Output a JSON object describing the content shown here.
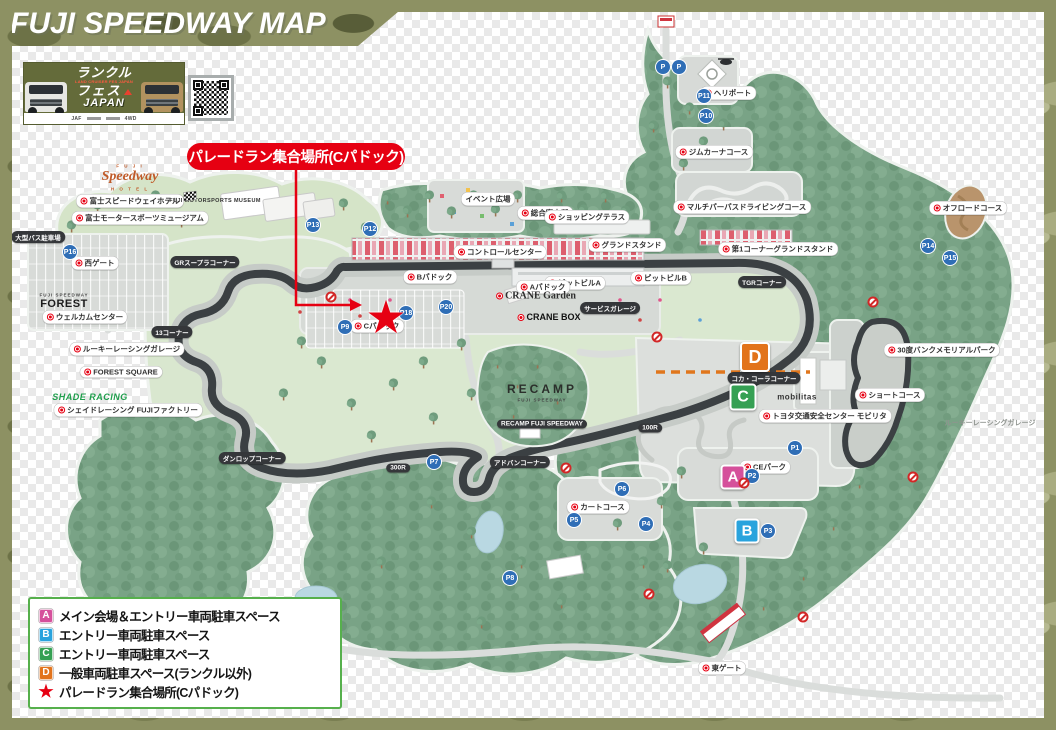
{
  "header": {
    "title": "FUJI SPEEDWAY MAP"
  },
  "banner": {
    "line1": "ランクル",
    "tagline": "LAND CRUISER FES JAPAN",
    "line2": "フェス",
    "line3": "JAPAN",
    "sponsor_left": "JAF",
    "sponsor_right": "4WD"
  },
  "callout": {
    "text": "パレードラン集合場所(Cパドック)"
  },
  "legend": {
    "items": [
      {
        "key": "A",
        "color": "#d5509b",
        "label": "メイン会場＆エントリー車両駐車スペース"
      },
      {
        "key": "B",
        "color": "#29a3dd",
        "label": "エントリー車両駐車スペース"
      },
      {
        "key": "C",
        "color": "#35a053",
        "label": "エントリー車両駐車スペース"
      },
      {
        "key": "D",
        "color": "#e2731b",
        "label": "一般車両駐車スペース(ランクル以外)"
      },
      {
        "key": "★",
        "color": "#e60012",
        "label": "パレードラン集合場所(Cパドック)"
      }
    ]
  },
  "colors": {
    "accent_red": "#e60012",
    "camo_olive": "#8d9163",
    "forest_green": "#79a386",
    "track_dark": "#3b4043",
    "parking_blue": "#2f6eb6",
    "dashed_orange": "#e0761c",
    "legend_border": "#56b04c"
  },
  "map": {
    "star": {
      "x": 374,
      "y": 305,
      "glyph": "★"
    },
    "area_markers": [
      {
        "letter": "A",
        "x": 733,
        "y": 477,
        "size": 21,
        "color": "#d5509b"
      },
      {
        "letter": "B",
        "x": 747,
        "y": 531,
        "size": 21,
        "color": "#29a3dd"
      },
      {
        "letter": "C",
        "x": 743,
        "y": 397,
        "size": 23,
        "color": "#35a053"
      },
      {
        "letter": "D",
        "x": 755,
        "y": 357,
        "size": 26,
        "color": "#e2731b"
      }
    ],
    "parkings": [
      {
        "n": "P",
        "x": 663,
        "y": 67
      },
      {
        "n": "P",
        "x": 679,
        "y": 67
      },
      {
        "n": "P11",
        "x": 704,
        "y": 96
      },
      {
        "n": "P10",
        "x": 706,
        "y": 116
      },
      {
        "n": "P13",
        "x": 313,
        "y": 225
      },
      {
        "n": "P12",
        "x": 370,
        "y": 229
      },
      {
        "n": "P14",
        "x": 928,
        "y": 246
      },
      {
        "n": "P15",
        "x": 950,
        "y": 258
      },
      {
        "n": "P16",
        "x": 70,
        "y": 252
      },
      {
        "n": "P9",
        "x": 345,
        "y": 327
      },
      {
        "n": "P18",
        "x": 406,
        "y": 313
      },
      {
        "n": "P20",
        "x": 446,
        "y": 307
      },
      {
        "n": "P7",
        "x": 434,
        "y": 462
      },
      {
        "n": "P8",
        "x": 510,
        "y": 578
      },
      {
        "n": "P6",
        "x": 622,
        "y": 489
      },
      {
        "n": "P5",
        "x": 574,
        "y": 520
      },
      {
        "n": "P4",
        "x": 646,
        "y": 524
      },
      {
        "n": "P3",
        "x": 768,
        "y": 531
      },
      {
        "n": "P2",
        "x": 752,
        "y": 476
      },
      {
        "n": "P1",
        "x": 795,
        "y": 448
      }
    ],
    "no_entry": [
      [
        331,
        297
      ],
      [
        657,
        337
      ],
      [
        744,
        483
      ],
      [
        873,
        302
      ],
      [
        913,
        477
      ],
      [
        649,
        594
      ],
      [
        803,
        617
      ],
      [
        566,
        468
      ]
    ],
    "labels": [
      {
        "name": "label-fuji-sub",
        "text": "F U J I",
        "x": 130,
        "y": 166,
        "t": "script-sub"
      },
      {
        "name": "label-speedway-hotel-script",
        "text": "Speedway",
        "x": 130,
        "y": 177,
        "t": "script"
      },
      {
        "name": "label-hotel-sub",
        "text": "H O T E L",
        "x": 130,
        "y": 189,
        "t": "script-sub"
      },
      {
        "name": "label-fuji-speedway-hotel",
        "text": "富士スピードウェイホテル",
        "x": 130,
        "y": 201,
        "t": "pill",
        "dot": true
      },
      {
        "name": "label-fuji-motorsports-museum-en",
        "text": "FUJI MOTORSPORTS MUSEUM",
        "x": 215,
        "y": 201,
        "t": "plain"
      },
      {
        "name": "label-fuji-motorsports-museum",
        "text": "富士モータースポーツミュージアム",
        "x": 140,
        "y": 218,
        "t": "pill",
        "dot": true
      },
      {
        "name": "label-bus-parking",
        "text": "大型バス駐車場",
        "x": 38,
        "y": 237,
        "t": "dark"
      },
      {
        "name": "label-west-gate",
        "text": "西ゲート",
        "x": 95,
        "y": 263,
        "t": "pill",
        "dot": true
      },
      {
        "name": "label-welcome-center",
        "text": "ウェルカムセンター",
        "x": 85,
        "y": 317,
        "t": "pill",
        "dot": true
      },
      {
        "name": "label-forest-logo-sub",
        "text": "FUJI SPEEDWAY",
        "x": 64,
        "y": 295,
        "t": "logo-sub"
      },
      {
        "name": "label-forest-logo",
        "text": "FOREST",
        "x": 64,
        "y": 304,
        "t": "logo-forest"
      },
      {
        "name": "label-rookie-racing-garage",
        "text": "ルーキーレーシングガレージ",
        "x": 127,
        "y": 349,
        "t": "pill",
        "dot": true
      },
      {
        "name": "label-forest-square",
        "text": "FOREST SQUARE",
        "x": 121,
        "y": 372,
        "t": "pill",
        "dot": true
      },
      {
        "name": "label-shade-racing-logo",
        "text": "SHADE RACING",
        "x": 90,
        "y": 397,
        "t": "logo-shade"
      },
      {
        "name": "label-shade-racing-factory",
        "text": "シェイドレーシング FUJIファクトリー",
        "x": 128,
        "y": 410,
        "t": "pill",
        "dot": true
      },
      {
        "name": "label-event-plaza",
        "text": "イベント広場",
        "x": 488,
        "y": 199,
        "t": "pill"
      },
      {
        "name": "label-info-center",
        "text": "総合案内所",
        "x": 545,
        "y": 213,
        "t": "pill",
        "dot": true
      },
      {
        "name": "label-shopping-terrace",
        "text": "ショッピングテラス",
        "x": 587,
        "y": 217,
        "t": "pill",
        "dot": true
      },
      {
        "name": "label-control-center",
        "text": "コントロールセンター",
        "x": 500,
        "y": 252,
        "t": "pill",
        "dot": true
      },
      {
        "name": "label-grandstand",
        "text": "グランドスタンド",
        "x": 627,
        "y": 245,
        "t": "pill",
        "dot": true
      },
      {
        "name": "label-t1-grandstand",
        "text": "第1コーナーグランドスタンド",
        "x": 778,
        "y": 249,
        "t": "pill",
        "dot": true
      },
      {
        "name": "label-pit-building-a",
        "text": "ピットビルA",
        "x": 575,
        "y": 283,
        "t": "pill",
        "dot": true
      },
      {
        "name": "label-pit-building-b",
        "text": "ピットビルB",
        "x": 661,
        "y": 278,
        "t": "pill",
        "dot": true
      },
      {
        "name": "label-a-paddock",
        "text": "Aパドック",
        "x": 543,
        "y": 287,
        "t": "pill",
        "dot": true
      },
      {
        "name": "label-b-paddock",
        "text": "Bパドック",
        "x": 430,
        "y": 277,
        "t": "pill",
        "dot": true
      },
      {
        "name": "label-c-paddock",
        "text": "Cパドック",
        "x": 377,
        "y": 326,
        "t": "pill",
        "dot": true
      },
      {
        "name": "label-crane-garden",
        "text": "CRANE Garden",
        "x": 536,
        "y": 296,
        "t": "crane",
        "dot": true
      },
      {
        "name": "label-crane-box",
        "text": "CRANE BOX",
        "x": 549,
        "y": 317,
        "t": "crane-box",
        "dot": true
      },
      {
        "name": "label-service-garage",
        "text": "サービスガレージ",
        "x": 610,
        "y": 308,
        "t": "dark"
      },
      {
        "name": "label-recamp",
        "text": "RECAMP",
        "x": 542,
        "y": 389,
        "t": "recamp"
      },
      {
        "name": "label-recamp-sub",
        "text": "FUJI SPEEDWAY",
        "x": 542,
        "y": 400,
        "t": "logo-sub"
      },
      {
        "name": "label-recamp-pill",
        "text": "RECAMP FUJI SPEEDWAY",
        "x": 542,
        "y": 424,
        "t": "dark"
      },
      {
        "name": "label-mobilitas-logo",
        "text": "mobilitas",
        "x": 797,
        "y": 397,
        "t": "mobilitas"
      },
      {
        "name": "label-mobilitas",
        "text": "トヨタ交通安全センター モビリタ",
        "x": 825,
        "y": 416,
        "t": "pill",
        "dot": true
      },
      {
        "name": "label-short-course",
        "text": "ショートコース",
        "x": 890,
        "y": 395,
        "t": "pill",
        "dot": true
      },
      {
        "name": "label-30bank",
        "text": "30度バンクメモリアルパーク",
        "x": 942,
        "y": 350,
        "t": "pill",
        "dot": true
      },
      {
        "name": "label-offroad-course",
        "text": "オフロードコース",
        "x": 968,
        "y": 208,
        "t": "pill",
        "dot": true
      },
      {
        "name": "label-gymkhana-course",
        "text": "ジムカーナコース",
        "x": 714,
        "y": 152,
        "t": "pill",
        "dot": true
      },
      {
        "name": "label-multipurpose-course",
        "text": "マルチパーパスドライビングコース",
        "x": 742,
        "y": 207,
        "t": "pill",
        "dot": true
      },
      {
        "name": "label-heliport",
        "text": "ヘリポート",
        "x": 728,
        "y": 93,
        "t": "pill",
        "dot": true
      },
      {
        "name": "label-kart-course",
        "text": "カートコース",
        "x": 598,
        "y": 507,
        "t": "pill",
        "dot": true
      },
      {
        "name": "label-ce-park",
        "text": "CEパーク",
        "x": 765,
        "y": 467,
        "t": "pill",
        "dot": true
      },
      {
        "name": "label-east-gate",
        "text": "東ゲート",
        "x": 722,
        "y": 668,
        "t": "pill",
        "dot": true
      },
      {
        "name": "label-rookie-right",
        "text": "ルーキーレーシングガレージ",
        "x": 990,
        "y": 423,
        "t": "gray"
      },
      {
        "name": "label-corner-t1",
        "text": "TGRコーナー",
        "x": 762,
        "y": 282,
        "t": "dark"
      },
      {
        "name": "label-corner-cocacola",
        "text": "コカ・コーラコーナー",
        "x": 764,
        "y": 378,
        "t": "dark"
      },
      {
        "name": "label-corner-100r",
        "text": "100R",
        "x": 650,
        "y": 428,
        "t": "dark"
      },
      {
        "name": "label-corner-advan",
        "text": "アドバンコーナー",
        "x": 520,
        "y": 462,
        "t": "dark"
      },
      {
        "name": "label-corner-300r",
        "text": "300R",
        "x": 398,
        "y": 468,
        "t": "dark"
      },
      {
        "name": "label-corner-dunlop",
        "text": "ダンロップコーナー",
        "x": 252,
        "y": 458,
        "t": "dark"
      },
      {
        "name": "label-corner-13",
        "text": "13コーナー",
        "x": 172,
        "y": 332,
        "t": "dark"
      },
      {
        "name": "label-corner-grsupra",
        "text": "GRスープラコーナー",
        "x": 205,
        "y": 262,
        "t": "dark"
      }
    ]
  }
}
